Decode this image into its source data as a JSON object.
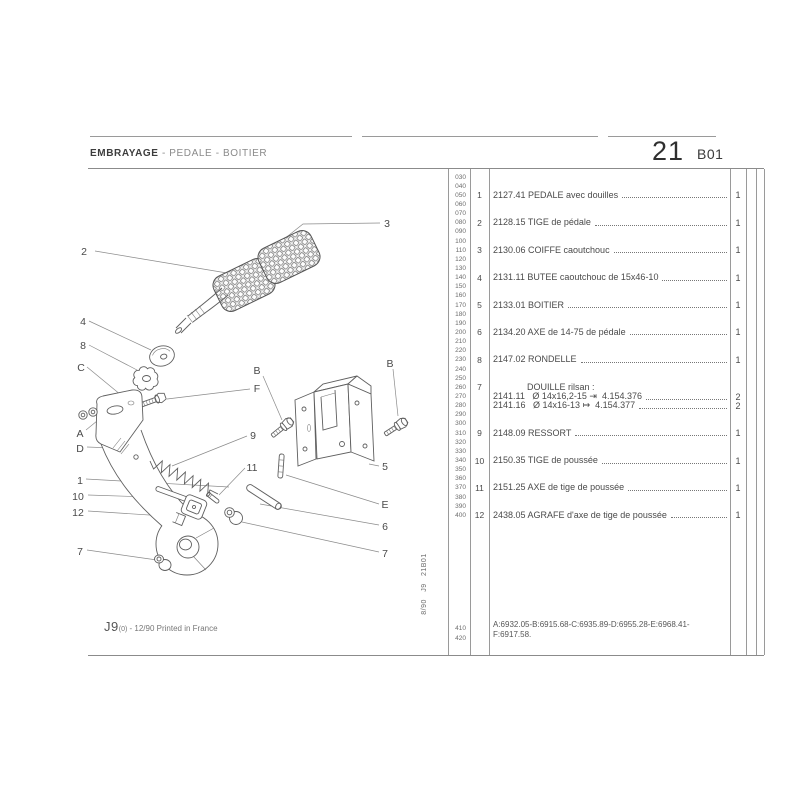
{
  "header": {
    "title_main": "EMBRAYAGE",
    "title_sub": " - PEDALE - BOITIER",
    "page_number": "21",
    "page_code": "B01"
  },
  "side_code": "8/90   J9   21B01",
  "footer": {
    "model": "J9",
    "revision": "(0)",
    "print_info": " - 12/90 Printed in France"
  },
  "table": {
    "codes": [
      "030",
      "040",
      "050",
      "060",
      "070",
      "080",
      "090",
      "100",
      "110",
      "120",
      "130",
      "140",
      "150",
      "160",
      "170",
      "180",
      "190",
      "200",
      "210",
      "220",
      "230",
      "240",
      "250",
      "260",
      "270",
      "280",
      "290",
      "300",
      "310",
      "320",
      "330",
      "340",
      "350",
      "360",
      "370",
      "380",
      "390",
      "400"
    ],
    "bottom_codes": [
      "410",
      "420"
    ],
    "rows": [
      {
        "code": 50,
        "item": "1",
        "text": "2127.41 PEDALE avec douilles",
        "qty": "1",
        "dots": true,
        "indent": 0
      },
      {
        "code": 80,
        "item": "2",
        "text": "2128.15 TIGE de pédale",
        "qty": "1",
        "dots": true,
        "indent": 0
      },
      {
        "code": 110,
        "item": "3",
        "text": "2130.06 COIFFE caoutchouc",
        "qty": "1",
        "dots": true,
        "indent": 0
      },
      {
        "code": 140,
        "item": "4",
        "text": "2131.11 BUTEE caoutchouc de 15x46-10",
        "qty": "1",
        "dots": true,
        "indent": 0
      },
      {
        "code": 170,
        "item": "5",
        "text": "2133.01 BOITIER",
        "qty": "1",
        "dots": true,
        "indent": 0
      },
      {
        "code": 200,
        "item": "6",
        "text": "2134.20 AXE de 14-75 de pédale",
        "qty": "1",
        "dots": true,
        "indent": 0
      },
      {
        "code": 230,
        "item": "8",
        "text": "2147.02 RONDELLE",
        "qty": "1",
        "dots": true,
        "indent": 0
      },
      {
        "code": 260,
        "item": "7",
        "text": "DOUILLE rilsan :",
        "qty": "",
        "dots": false,
        "indent": 34
      },
      {
        "code": 270,
        "item": "",
        "text": "2141.11   Ø 14x16,2-15 ⇥  4.154.376",
        "qty": "2",
        "dots": true,
        "indent": 0
      },
      {
        "code": 280,
        "item": "",
        "text": "2141.16   Ø 14x16-13 ↦  4.154.377",
        "qty": "2",
        "dots": true,
        "indent": 0
      },
      {
        "code": 310,
        "item": "9",
        "text": "2148.09 RESSORT",
        "qty": "1",
        "dots": true,
        "indent": 0
      },
      {
        "code": 340,
        "item": "10",
        "text": "2150.35 TIGE de poussée",
        "qty": "1",
        "dots": true,
        "indent": 0
      },
      {
        "code": 370,
        "item": "11",
        "text": "2151.25 AXE de tige de poussée",
        "qty": "1",
        "dots": true,
        "indent": 0
      },
      {
        "code": 400,
        "item": "12",
        "text": "2438.05 AGRAFE d'axe de tige de poussée",
        "qty": "1",
        "dots": true,
        "indent": 0
      }
    ],
    "footnote_line1": "A:6932.05-B:6915.68-C:6935.89-D:6955.28-E:6968.41-",
    "footnote_line2": "F:6917.58."
  },
  "diagram": {
    "callouts": [
      {
        "label": "2"
      },
      {
        "label": "3"
      },
      {
        "label": "4"
      },
      {
        "label": "8"
      },
      {
        "label": "C"
      },
      {
        "label": "B"
      },
      {
        "label": "F"
      },
      {
        "label": "B"
      },
      {
        "label": "A"
      },
      {
        "label": "D"
      },
      {
        "label": "1"
      },
      {
        "label": "10"
      },
      {
        "label": "12"
      },
      {
        "label": "7"
      },
      {
        "label": "9"
      },
      {
        "label": "11"
      },
      {
        "label": "5"
      },
      {
        "label": "E"
      },
      {
        "label": "6"
      },
      {
        "label": "7"
      }
    ]
  }
}
